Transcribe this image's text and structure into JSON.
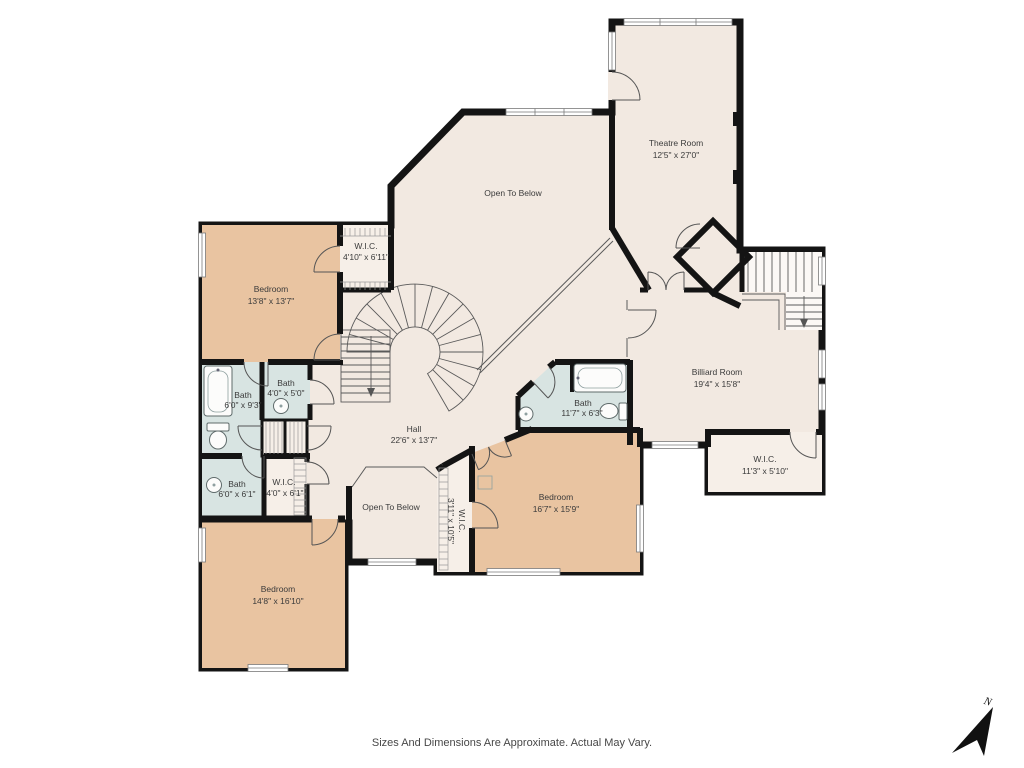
{
  "meta": {
    "disclaimer": "Sizes And Dimensions Are Approximate. Actual May Vary.",
    "compass": "N"
  },
  "colors": {
    "floor": "#f2e9e1",
    "bedroom": "#e9c4a1",
    "bath": "#d8e4e2",
    "wic": "#f6efe8",
    "stair": "#fbf8f5",
    "wall": "#141414"
  },
  "rooms": {
    "theatre": {
      "name": "Theatre Room",
      "dims": "12'5\" x 27'0\""
    },
    "open_below_large": {
      "name": "Open To Below"
    },
    "bedroom_tl": {
      "name": "Bedroom",
      "dims": "13'8\" x 13'7\""
    },
    "wic_tl": {
      "name": "W.I.C.",
      "dims": "4'10\" x 6'11\""
    },
    "bath_93": {
      "name": "Bath",
      "dims": "6'0\" x 9'3\""
    },
    "bath_50": {
      "name": "Bath",
      "dims": "4'0\" x 5'0\""
    },
    "bath_61": {
      "name": "Bath",
      "dims": "6'0\" x 6'1\""
    },
    "wic_40": {
      "name": "W.I.C.",
      "dims": "4'0\" x 6'1\""
    },
    "hall": {
      "name": "Hall",
      "dims": "22'6\" x 13'7\""
    },
    "open_below_small": {
      "name": "Open To Below"
    },
    "wic_vert": {
      "name": "W.I.C.",
      "dims": "3'11\" x 10'5\""
    },
    "bedroom_bl": {
      "name": "Bedroom",
      "dims": "14'8\" x 16'10\""
    },
    "bedroom_r": {
      "name": "Bedroom",
      "dims": "16'7\" x 15'9\""
    },
    "bath_117": {
      "name": "Bath",
      "dims": "11'7\" x 6'3\""
    },
    "billiard": {
      "name": "Billiard Room",
      "dims": "19'4\" x 15'8\""
    },
    "wic_113": {
      "name": "W.I.C.",
      "dims": "11'3\" x 5'10\""
    }
  }
}
